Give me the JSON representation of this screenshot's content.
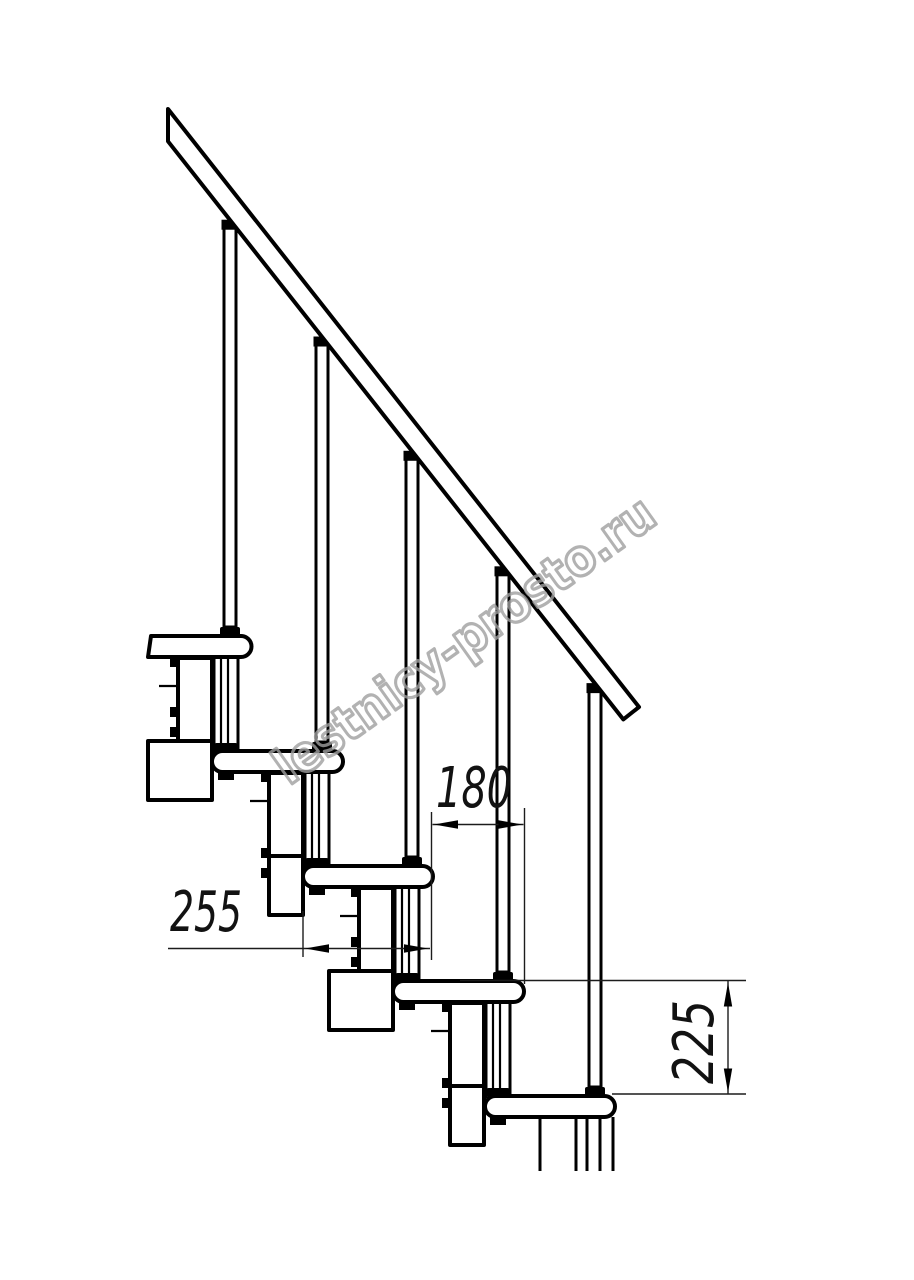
{
  "drawing": {
    "title": "staircase-fragment-side-view",
    "watermark": "lestnicy-prosto.ru",
    "background_color": "#ffffff",
    "line_color": "#000000",
    "watermark_color": "#9f9f9f",
    "steps_visible": 5,
    "balusters_visible": 5,
    "dimensions": {
      "tread_depth": {
        "value": "255",
        "orientation": "horizontal"
      },
      "step_run": {
        "value": "180",
        "orientation": "horizontal"
      },
      "step_rise": {
        "value": "225",
        "orientation": "vertical"
      }
    }
  }
}
